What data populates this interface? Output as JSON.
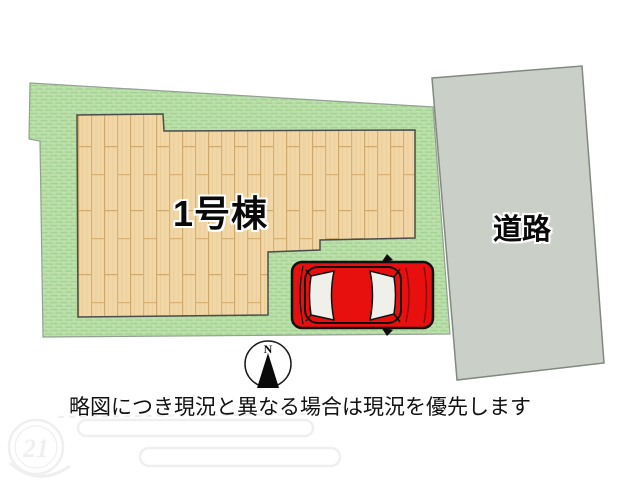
{
  "site_plan": {
    "building": {
      "label": "1号棟"
    },
    "road": {
      "label": "道路"
    },
    "compass": {
      "north_label": "N"
    },
    "disclaimer": "略図につき現況と異なる場合は現況を優先します",
    "watermark": {
      "label": "21"
    },
    "colors": {
      "grass": "#b8dfa7",
      "grass_stripe": "#a5d093",
      "wood": "#f1d6a6",
      "wood_line": "#cfa96e",
      "road": "#cad0c8",
      "car_red": "#e8100e",
      "window": "#f0f0ea"
    }
  }
}
